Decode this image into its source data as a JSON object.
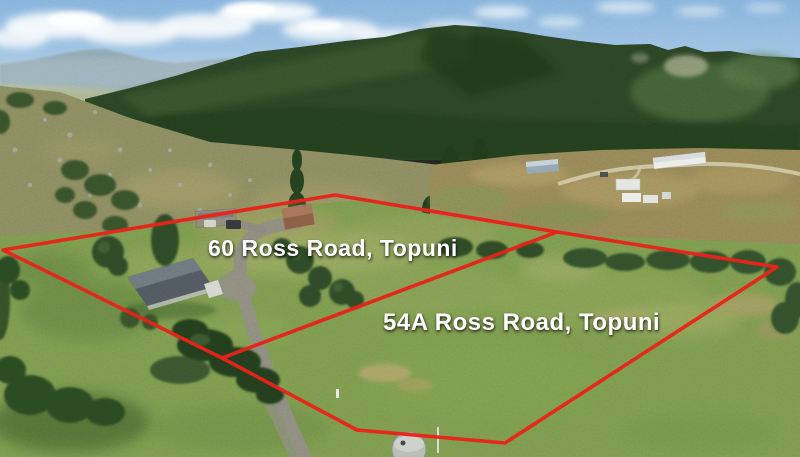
{
  "properties": [
    {
      "label": "60 Ross Road, Topuni"
    },
    {
      "label": "54A Ross Road, Topuni"
    }
  ],
  "boundaries": {
    "outer_points": "3,250 335,195 557,232 777,267 505,443 357,430 222,358",
    "divider_points": "222,358 557,232",
    "line_color": "#e8231a",
    "line_width": "3.6",
    "label_color": "#ffffff"
  }
}
